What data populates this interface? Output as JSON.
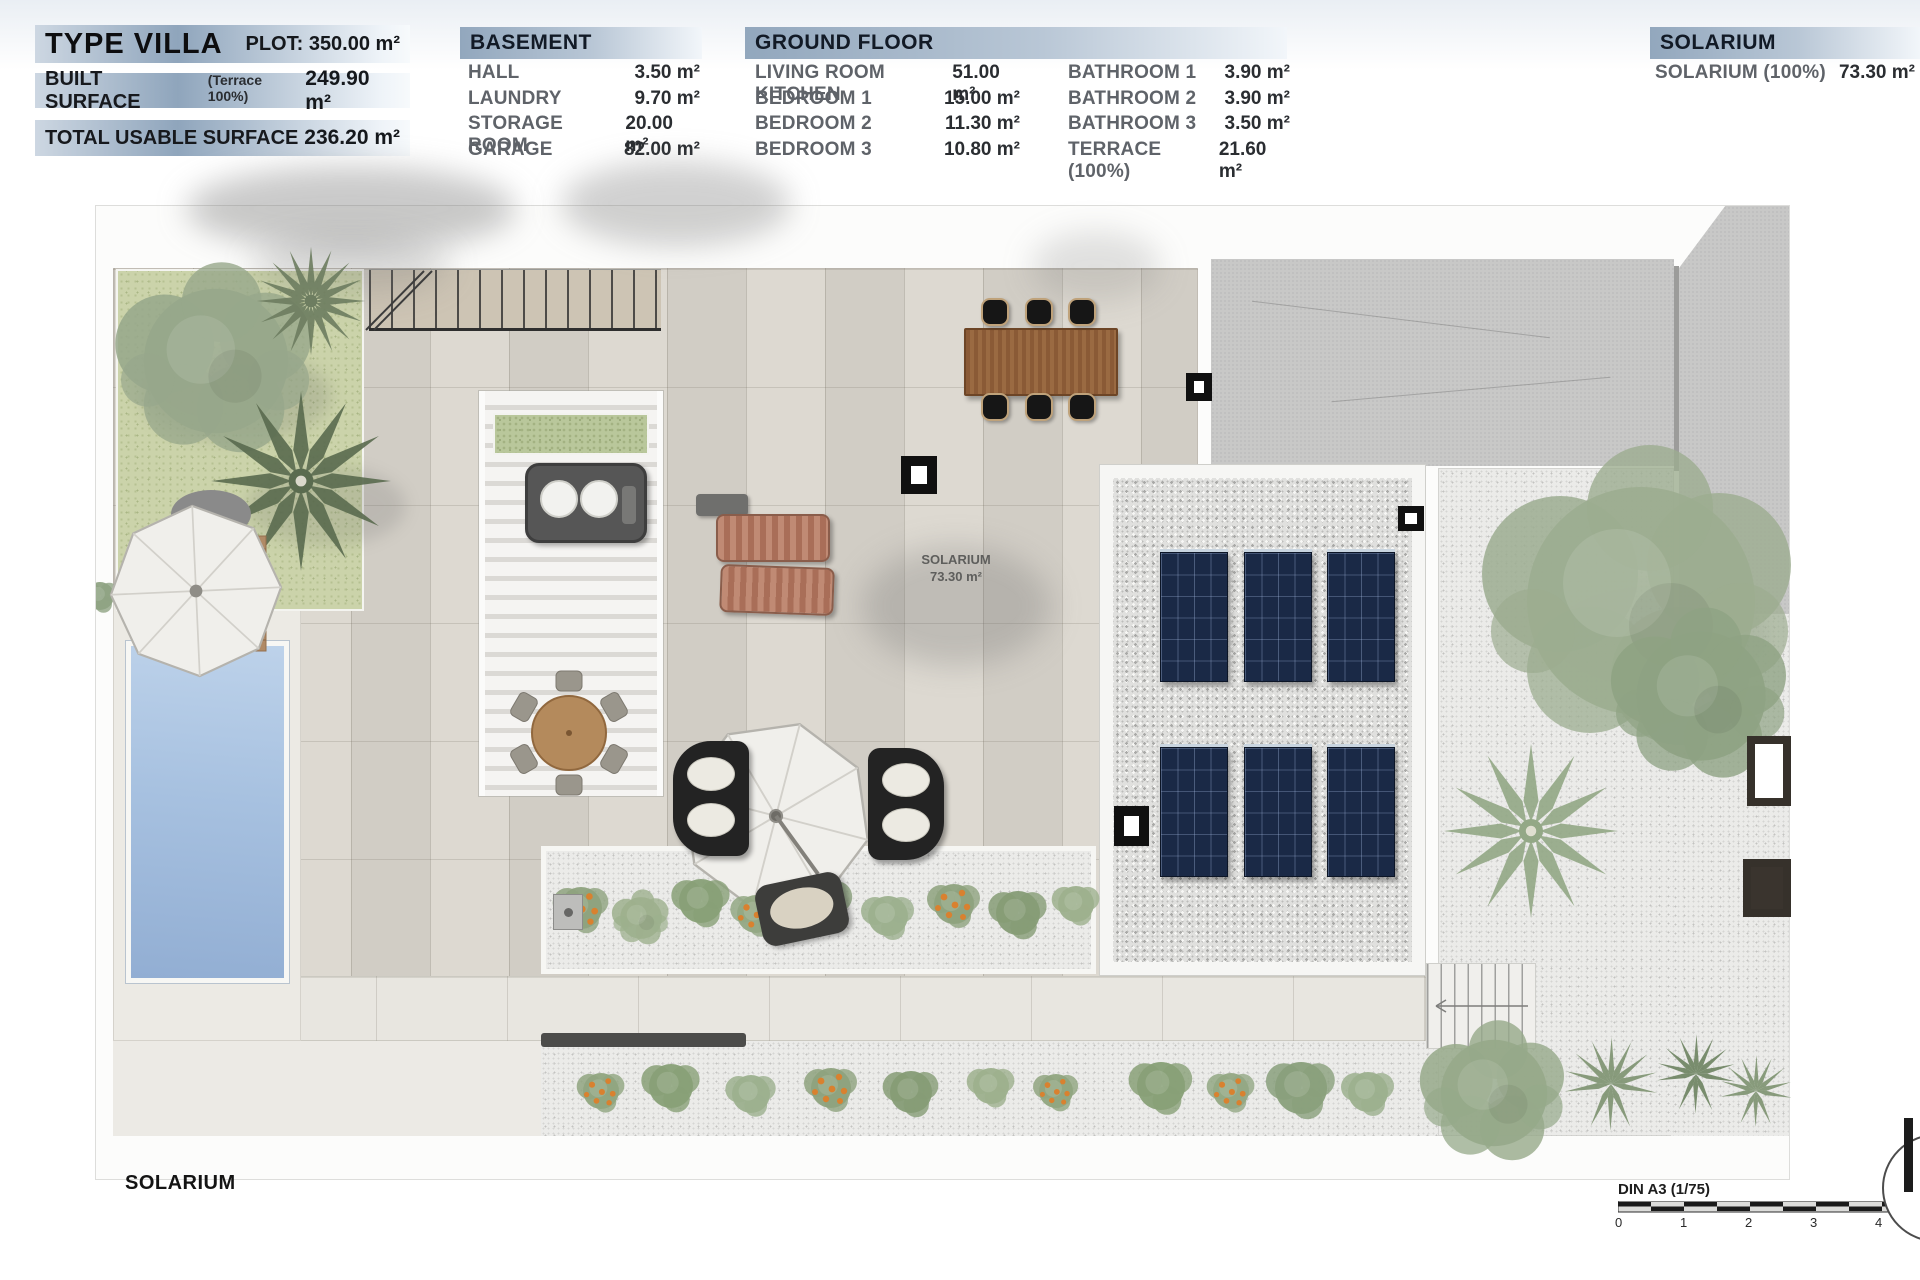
{
  "summary": {
    "title": "TYPE VILLA",
    "plot": "PLOT: 350.00 m²",
    "rows": [
      {
        "label": "BUILT SURFACE",
        "note": "(Terrace 100%)",
        "value": "249.90 m²"
      },
      {
        "label": "TOTAL USABLE SURFACE",
        "note": "",
        "value": "236.20 m²"
      }
    ]
  },
  "basement": {
    "title": "BASEMENT",
    "rows": [
      {
        "label": "HALL",
        "value": "3.50 m²"
      },
      {
        "label": "LAUNDRY",
        "value": "9.70 m²"
      },
      {
        "label": "STORAGE ROOM",
        "value": "20.00 m²"
      },
      {
        "label": "GARAGE",
        "value": "82.00 m²"
      }
    ]
  },
  "ground_floor": {
    "title": "GROUND FLOOR",
    "col1": [
      {
        "label": "LIVING ROOM KITCHEN",
        "value": "51.00 m²"
      },
      {
        "label": "BEDROOM 1",
        "value": "15.00 m²"
      },
      {
        "label": "BEDROOM 2",
        "value": "11.30 m²"
      },
      {
        "label": "BEDROOM 3",
        "value": "10.80 m²"
      }
    ],
    "col2": [
      {
        "label": "BATHROOM 1",
        "value": "3.90 m²"
      },
      {
        "label": "BATHROOM 2",
        "value": "3.90 m²"
      },
      {
        "label": "BATHROOM 3",
        "value": "3.50 m²"
      },
      {
        "label": "TERRACE (100%)",
        "value": "21.60 m²"
      }
    ]
  },
  "solarium_table": {
    "title": "SOLARIUM",
    "rows": [
      {
        "label": "SOLARIUM (100%)",
        "value": "73.30 m²"
      }
    ]
  },
  "plan": {
    "room_label": "SOLARIUM",
    "room_area": "73.30 m²",
    "floor_caption": "SOLARIUM"
  },
  "scale_bar": {
    "label": "DIN A3 (1/75)",
    "ticks": [
      "0",
      "1",
      "2",
      "3",
      "4"
    ]
  },
  "colors": {
    "accent_bar": "#8fa5bc",
    "panel_blue": "#1a2946",
    "pool_blue": "#a7c1e0",
    "grass_green": "#cbd3aa"
  }
}
